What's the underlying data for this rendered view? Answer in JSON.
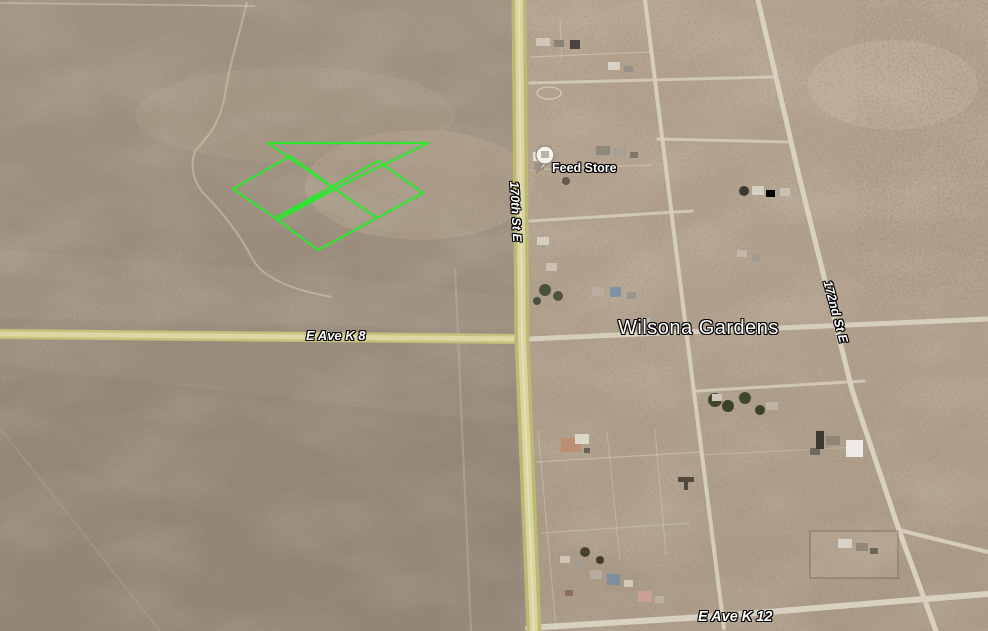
{
  "map": {
    "place_label": "Wilsona Gardens",
    "poi_label": "Feed Store",
    "roads": {
      "ave_k8": "E Ave K 8",
      "ave_k12": "E Ave K 12",
      "st_170": "170th St E",
      "st_172": "172nd St E"
    },
    "parcel": {
      "color": "#30e532",
      "top_line": "268,143 428,143",
      "diag_a": "268,143 377,218",
      "diag_b": "428,143 275,218",
      "left_quad": "290,156 335,189 278,220 233,189",
      "right_quad": "378,161 423,193 318,250 275,218"
    },
    "colors": {
      "paved_road": "#c8c37e",
      "paved_road_center": "#ddd7a4",
      "dirt_road": "#d8d1c0",
      "desert_west": "#9c8e7e",
      "desert_east": "#b1a08c",
      "label_text": "#ffffff"
    },
    "marker": {
      "icon": "place-balloon",
      "fill": "#f5f4ef"
    }
  }
}
